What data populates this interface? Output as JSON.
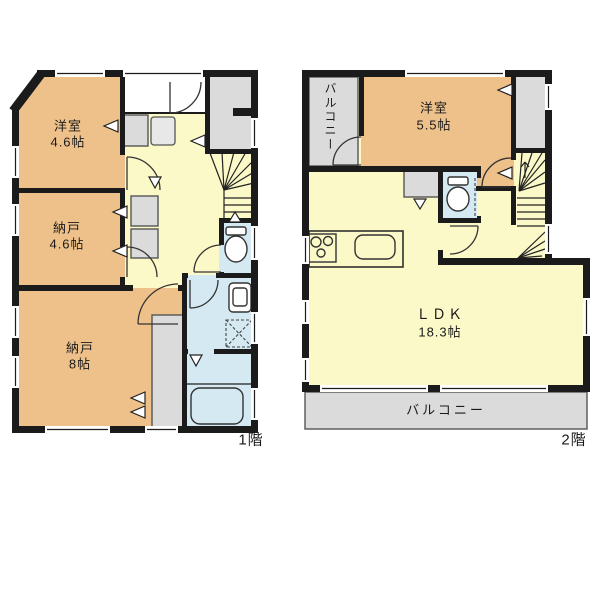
{
  "colors": {
    "room_orange": "#EFC18A",
    "hall_yellow": "#FBF9C8",
    "wet_blue": "#D4E9F2",
    "closet_gray": "#DBDBDB",
    "wall_dark": "#1b1b1b"
  },
  "floor1": {
    "floor_label": "1階",
    "rooms": {
      "youshitsu": {
        "name": "洋室",
        "size": "4.6帖"
      },
      "nando_small": {
        "name": "納戸",
        "size": "4.6帖"
      },
      "nando_large": {
        "name": "納戸",
        "size": "8帖"
      }
    }
  },
  "floor2": {
    "floor_label": "2階",
    "rooms": {
      "youshitsu": {
        "name": "洋室",
        "size": "5.5帖"
      },
      "ldk": {
        "name": "ＬＤＫ",
        "size": "18.3帖"
      },
      "balcony_top": {
        "name": "バルコニー"
      },
      "balcony_bottom": {
        "name": "バルコニー"
      }
    }
  }
}
